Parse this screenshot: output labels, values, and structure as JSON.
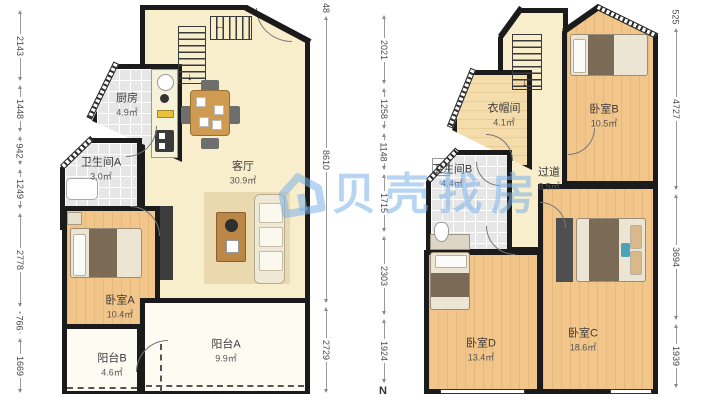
{
  "watermark": {
    "brand": "贝壳找房",
    "logo": "beike-house-logo",
    "color": "#7cb3ea"
  },
  "north": {
    "label": "N"
  },
  "icons": {
    "stairs_down_arrow": "↓",
    "stairs_left_arrow": "←"
  },
  "colors": {
    "wall": "#1b1b1b",
    "wood_floor": "#f2c68a",
    "light_wood_floor": "#f5dcab",
    "pale_floor": "#f8eecb",
    "tile_floor": "#e6e6e6",
    "balcony_floor": "#fcfcf3",
    "watermark_blue": "#7cb3ea"
  },
  "floor1": {
    "rooms": [
      {
        "id": "kitchen",
        "label": "厨房",
        "area": "4.9㎡"
      },
      {
        "id": "bathroomA",
        "label": "卫生间A",
        "area": "3.0㎡"
      },
      {
        "id": "living",
        "label": "客厅",
        "area": "30.9㎡"
      },
      {
        "id": "bedroomA",
        "label": "卧室A",
        "area": "10.4㎡"
      },
      {
        "id": "balconyB",
        "label": "阳台B",
        "area": "4.6㎡"
      },
      {
        "id": "balconyA",
        "label": "阳台A",
        "area": "9.9㎡"
      }
    ],
    "dims_left": [
      "2143",
      "1448",
      "942",
      "1249",
      "2778",
      "766",
      "1669"
    ],
    "dims_right": [
      "48",
      "8610",
      "2729"
    ]
  },
  "floor2": {
    "rooms": [
      {
        "id": "cloakroom",
        "label": "衣帽间",
        "area": "4.1㎡"
      },
      {
        "id": "bedroomB",
        "label": "卧室B",
        "area": "10.5㎡"
      },
      {
        "id": "bathroomB",
        "label": "卫生间B",
        "area": "4.4㎡"
      },
      {
        "id": "hallway",
        "label": "过道",
        "area": "8.5㎡"
      },
      {
        "id": "bedroomD",
        "label": "卧室D",
        "area": "13.4㎡"
      },
      {
        "id": "bedroomC",
        "label": "卧室C",
        "area": "18.6㎡"
      }
    ],
    "dims_left": [
      "2021",
      "1258",
      "1148",
      "1715",
      "2303",
      "1924"
    ],
    "dims_right": [
      "525",
      "4727",
      "3694",
      "1939"
    ]
  }
}
